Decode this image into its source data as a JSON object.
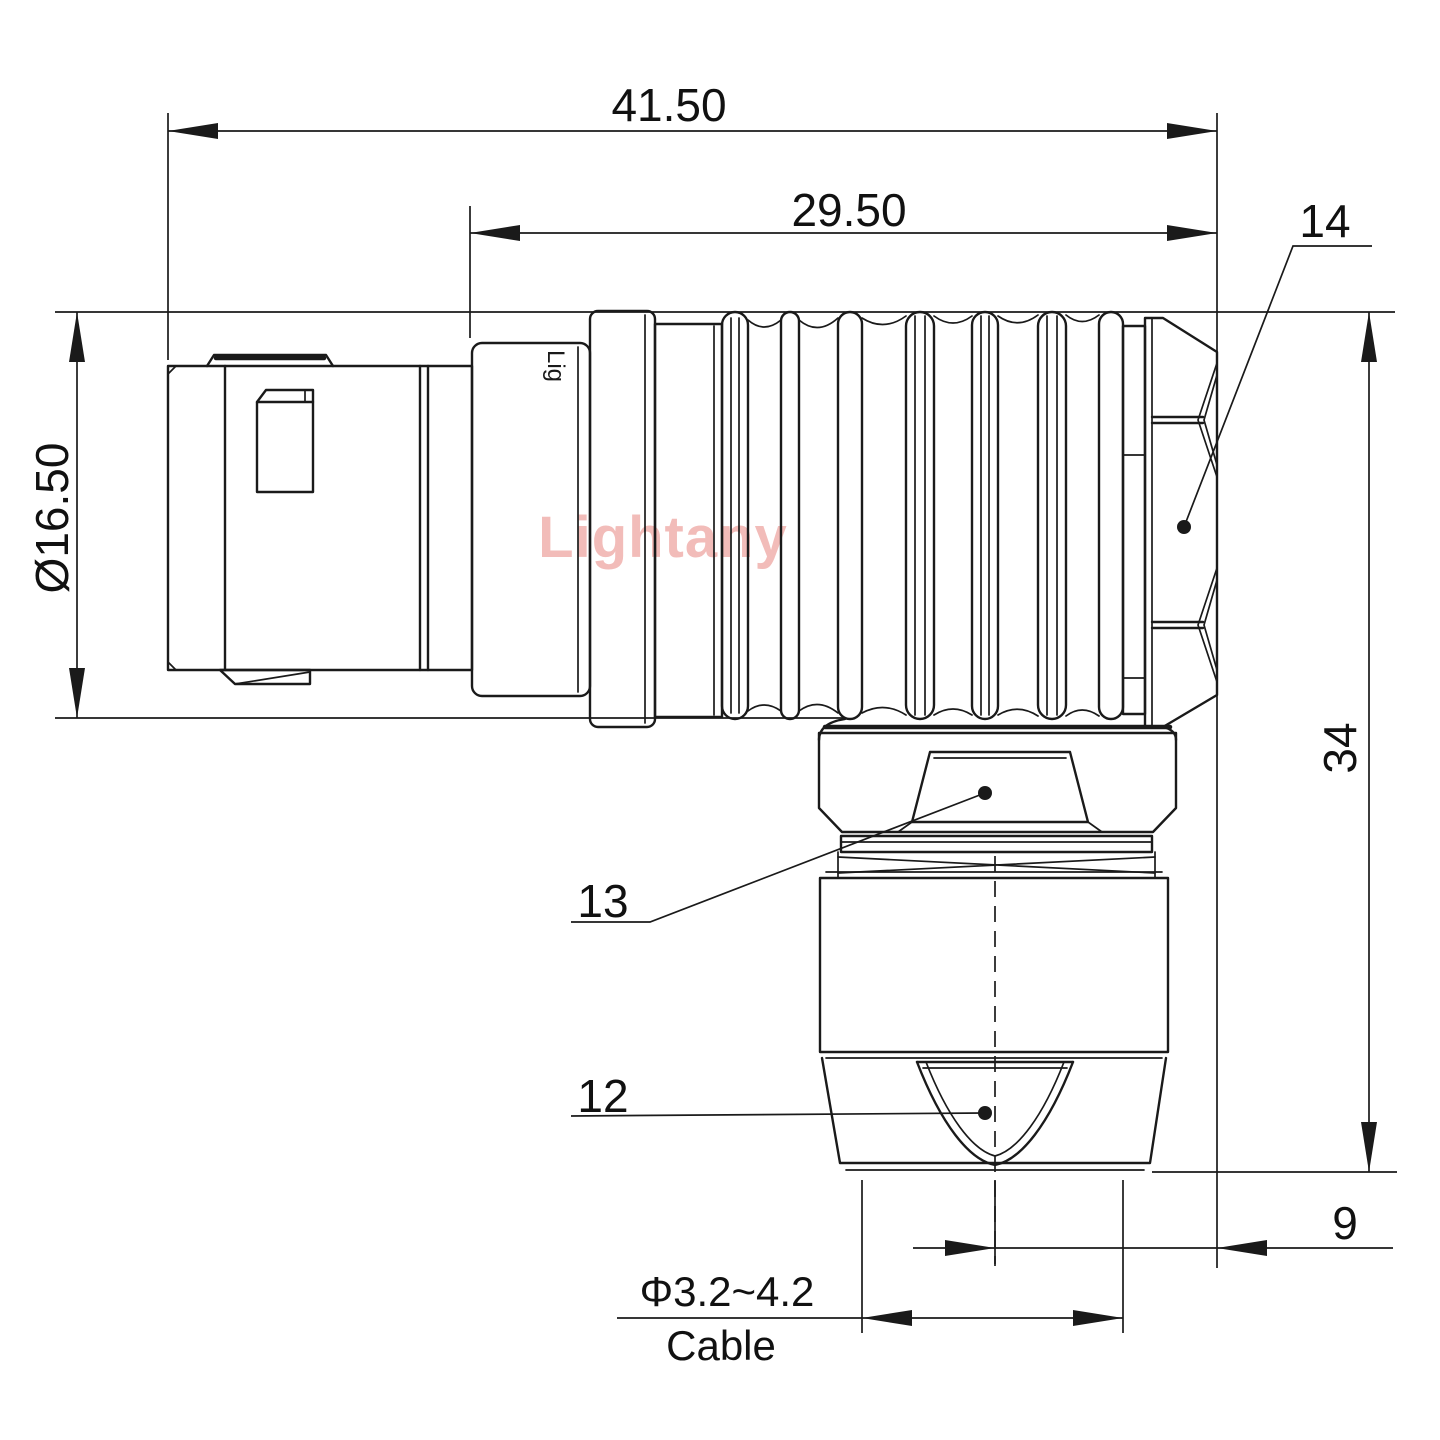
{
  "drawing": {
    "watermark": "Lightany",
    "sleeve_print": "Lig",
    "dimensions": {
      "total_length": "41.50",
      "body_length": "29.50",
      "outer_diameter": "Ø16.50",
      "height": "34",
      "offset": "9",
      "cable_range": "Φ3.2~4.2",
      "cable_label": "Cable"
    },
    "part_labels": {
      "backnut": "14",
      "gland_hex": "13",
      "cable_clamp": "12"
    },
    "colors": {
      "line": "#1a1a1a",
      "watermark": "#f2bcb9",
      "background": "#ffffff"
    }
  }
}
